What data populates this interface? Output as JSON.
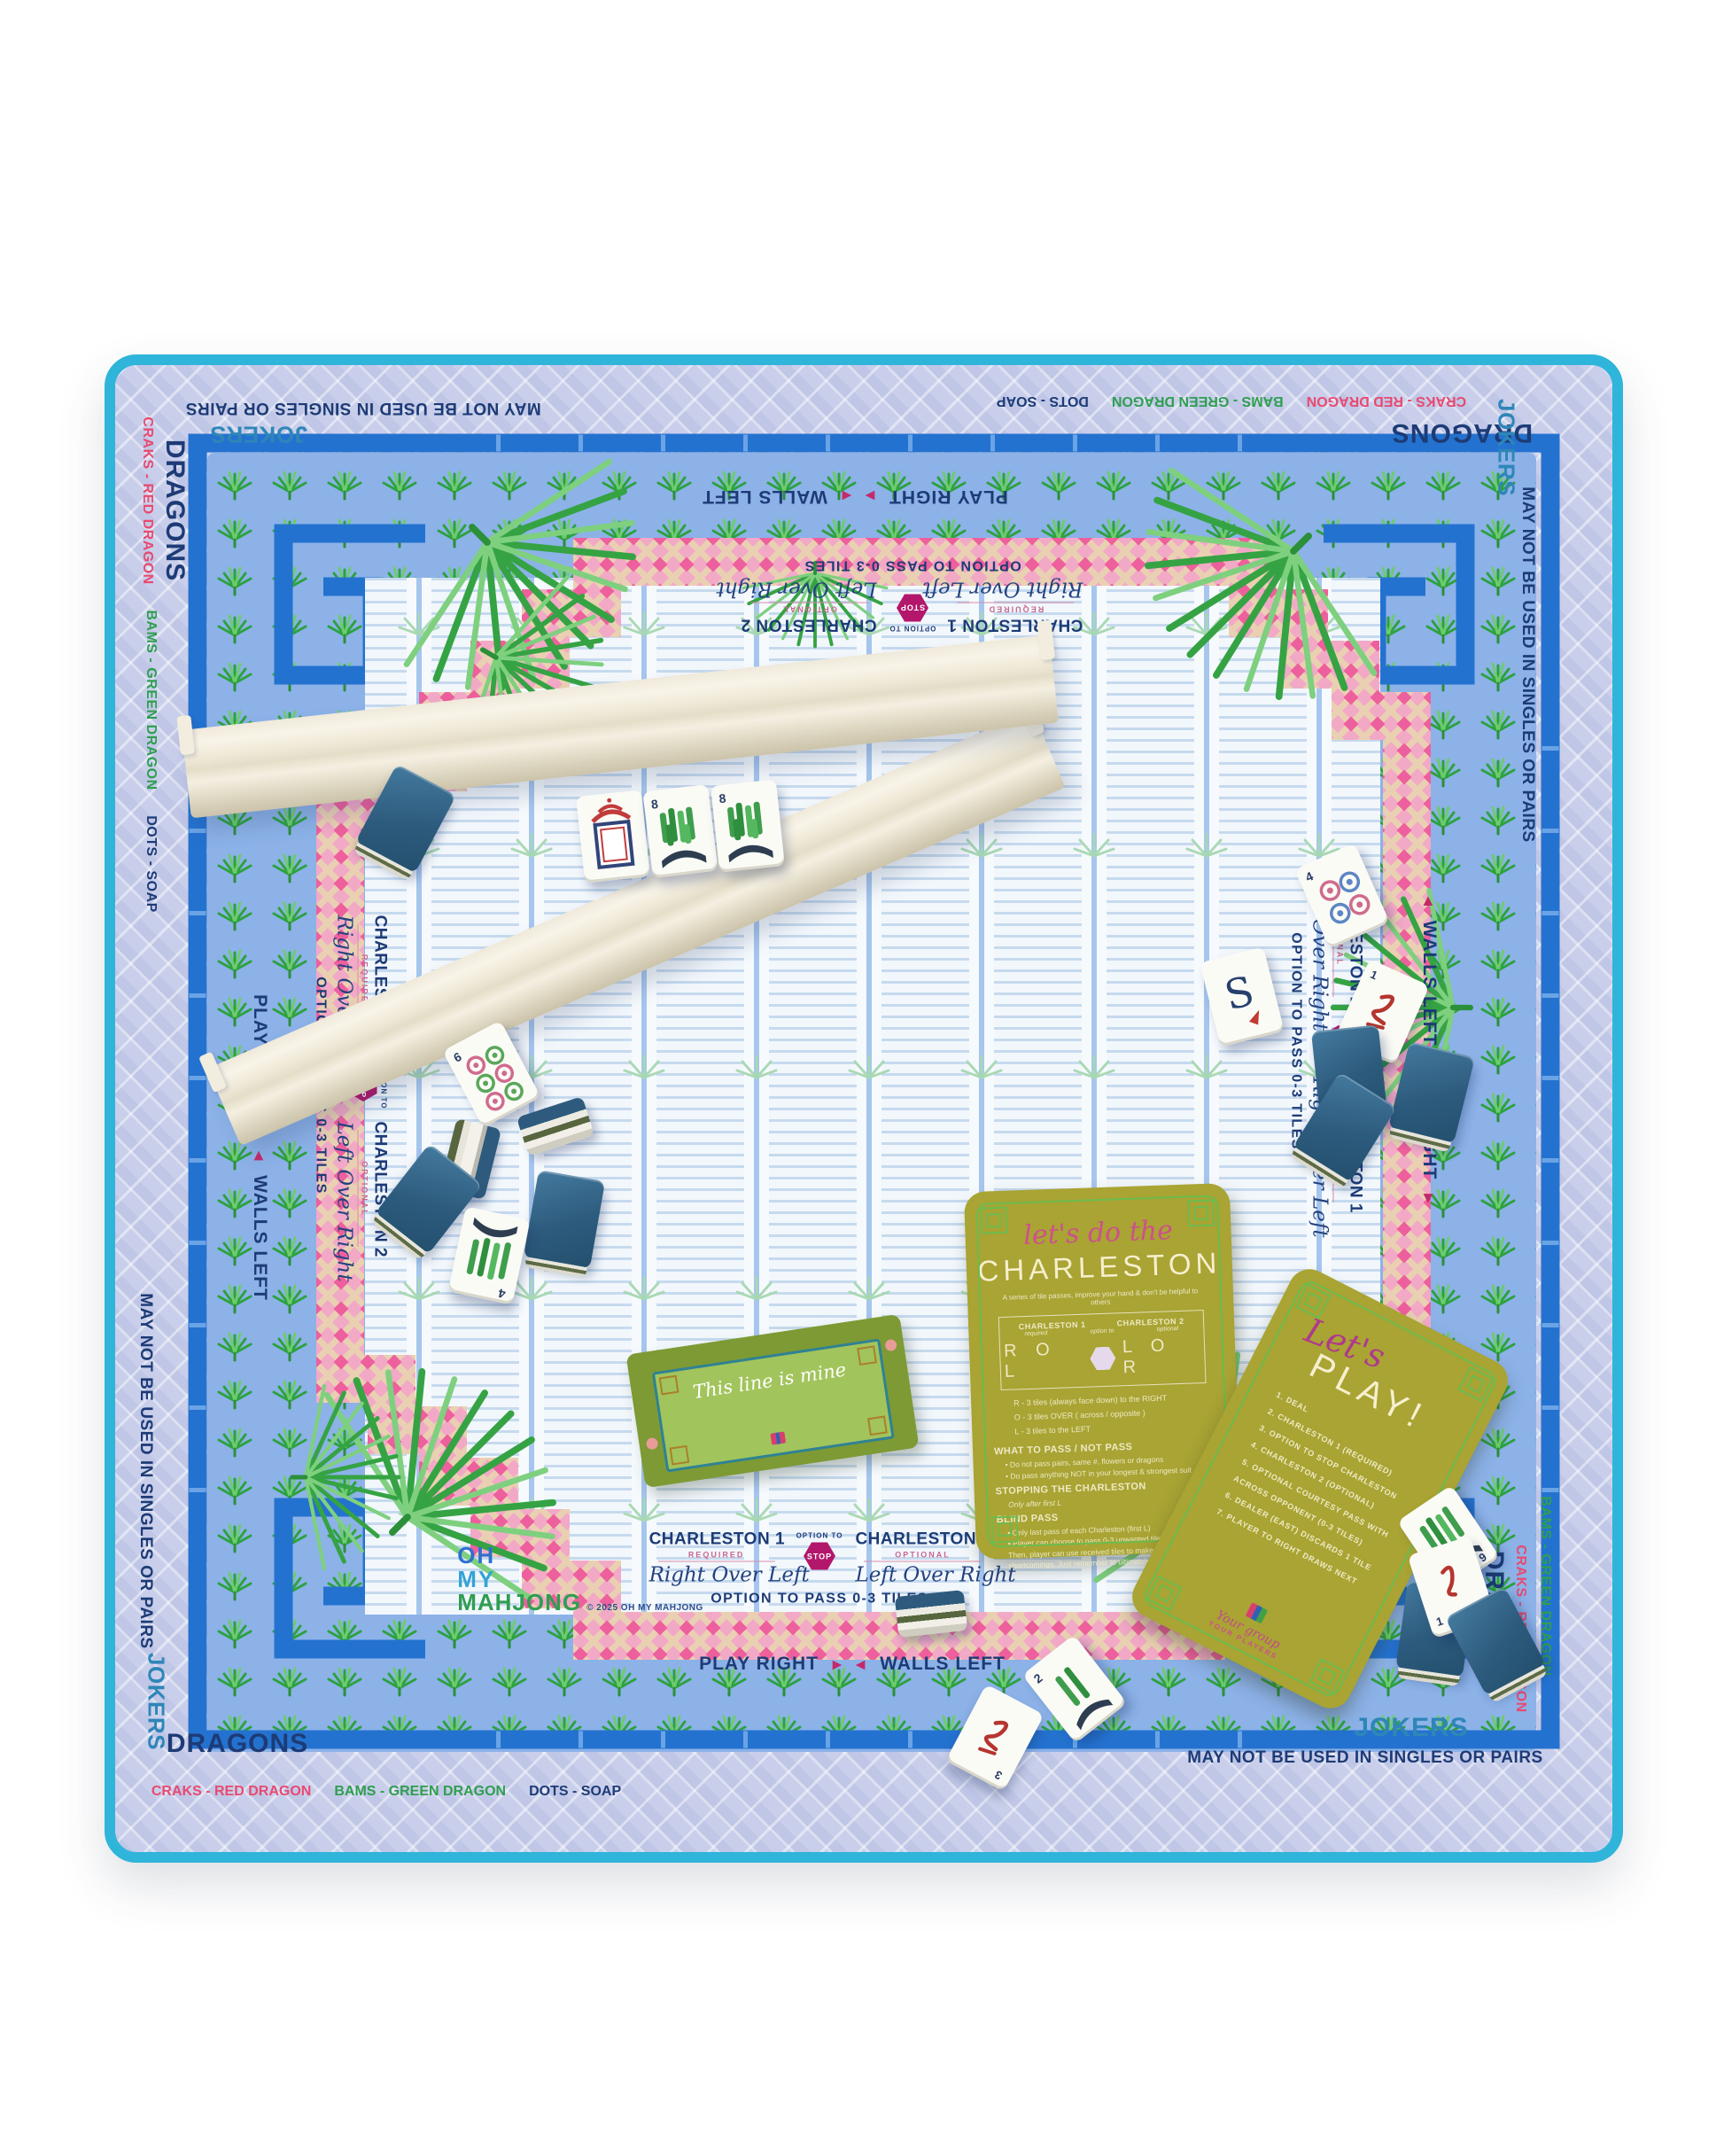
{
  "scene": {
    "background": "#ffffff",
    "subject": "Oh My Mahjong palm-print mahjong mat with racks, tiles and instruction cards"
  },
  "mat": {
    "binding_color": "#2fb4da",
    "quilt_color": "#c9cfeb",
    "bamboo_blue": "#2472cf",
    "band_blue": "#8cb2e8",
    "trellis_pink": "#f2a9c6",
    "palm_green": "#35a343",
    "field_bg": "#f2f7fc",
    "border_labels": {
      "dragons": "DRAGONS",
      "jokers": "JOKERS",
      "craks": "CRAKS - RED DRAGON",
      "bams": "BAMS - GREEN DRAGON",
      "dots": "DOTS - SOAP",
      "rule": "MAY NOT BE USED IN SINGLES OR PAIRS"
    },
    "band_labels": {
      "play_right": "PLAY RIGHT",
      "walls_left": "WALLS LEFT",
      "arrow_right": "▸",
      "arrow_left": "◂"
    },
    "charleston": {
      "c1": "CHARLESTON 1",
      "c1_sub": "REQUIRED",
      "c1_script": "Right Over Left",
      "option_to": "OPTION TO",
      "stop": "STOP",
      "c2": "CHARLESTON 2",
      "c2_sub": "OPTIONAL",
      "c2_script": "Left Over Right",
      "pass_note": "OPTION TO PASS 0-3 TILES"
    },
    "logo": {
      "line1": "OH",
      "line2": "MY",
      "line3": "MAHJONG",
      "copyright": "© 2025 OH MY MAHJONG"
    }
  },
  "cards": {
    "charleston": {
      "script": "let's do the",
      "title": "CHARLESTON",
      "subtitle": "A series of tile passes, improve your hand & don't be helpful to others",
      "col1": "CHARLESTON 1",
      "col1_sub": "required",
      "col2": "CHARLESTON 2",
      "col2_sub": "optional",
      "option_to": "option to",
      "letters1": "R O L",
      "letters2": "L O R",
      "legend": [
        "R - 3 tiles (always face down) to the RIGHT",
        "O - 3 tiles OVER ( across / opposite )",
        "L - 3 tiles to the LEFT"
      ],
      "s1_title": "WHAT TO PASS / NOT PASS",
      "s1_items": [
        "Do not pass pairs, same #, flowers or dragons",
        "Do pass anything NOT in your longest & strongest suit"
      ],
      "s2_title": "STOPPING THE CHARLESTON",
      "s2_note": "Only after first L",
      "s3_title": "BLIND PASS",
      "s3_items": [
        "Only last pass of each Charleston (first L)",
        "Player can choose to pass 0-3 unwanted tiles from their hand. Then, player can use received tiles to make up for any shortcomings. Just remember to ultimately pass 3 tiles."
      ]
    },
    "play": {
      "script": "Let's",
      "title": "PLAY!",
      "steps": [
        "1. DEAL",
        "2. CHARLESTON 1 (REQUIRED)",
        "3. OPTION TO STOP CHARLESTON",
        "4. CHARLESTON 2 (OPTIONAL)",
        "5. OPTIONAL COURTESY PASS WITH ACROSS OPPONENT (0-3 TILES)",
        "6. DEALER (EAST) DISCARDS 1 TILE",
        "7. PLAYER TO RIGHT DRAWS NEXT"
      ],
      "footer_script": "Your group",
      "footer_label": "YOUR PLAYERS"
    },
    "line": {
      "script": "This line is mine"
    }
  },
  "tiles": {
    "dot6": "6",
    "bam8": "8",
    "bam4": "4",
    "dot4": "4",
    "wind_south": "S",
    "crak_a": "1",
    "crak_b": "3",
    "crak_c": "1",
    "bam2": "2",
    "bam9": "9"
  },
  "icons": {
    "stop_badge": "hexagon-stop",
    "palm": "palm-frond",
    "direction_arrows": "play-direction-arrows"
  }
}
